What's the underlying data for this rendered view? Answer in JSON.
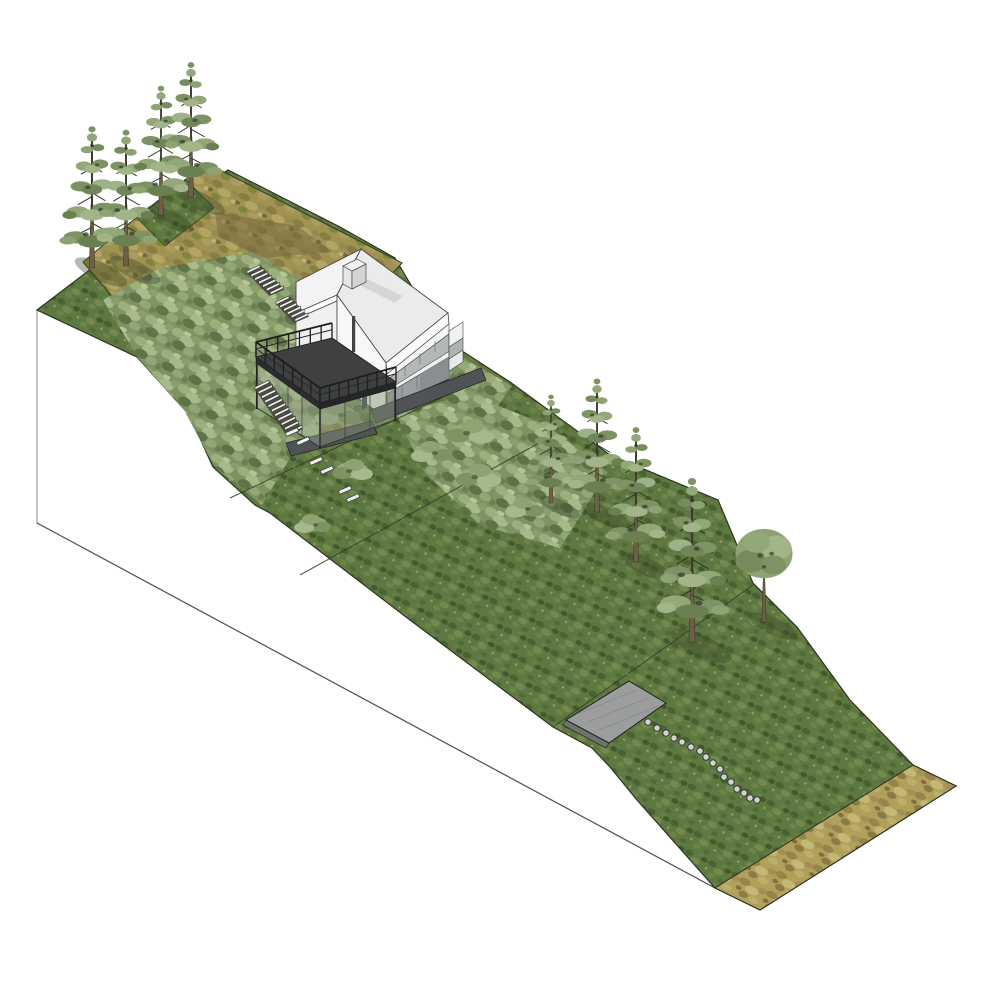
{
  "meta": {
    "title": "Hillside site axonometric rendering",
    "description": "Architectural 3D site-model rendering of a steep sloped parcel: gabled white house with timber deck, garden stairs, stepping stones, wildflower meadow terraces, a concrete pad, planting marker dots, a dry-grass strip at the toe of the slope, and conifer trees. White section-cut face on the lower left.",
    "view": "axonometric",
    "width_px": 1000,
    "height_px": 999
  },
  "palette": {
    "background": "#ffffff",
    "section_face": "#ffffff",
    "section_outline": "#8c8c8c",
    "terrain_outline": "#2d3620",
    "grass": "#5d7840",
    "grass_dark": "#49622f",
    "grass_light": "#74894d",
    "shrub": "#8aa06c",
    "meadow_tan": "#a09252",
    "dry_meadow": "#b0a05a",
    "earth_brown": "#74663f",
    "roof": "#ebebeb",
    "roof_left": "#f3f3f3",
    "wall": "#f6f6f6",
    "glazing": "#b4b8b9",
    "glazing_dark": "#898f90",
    "deck": "#3e4041",
    "path": "#4f5355",
    "pad": "#9b9e9c",
    "stair_tread": "#f0f0f0",
    "stepping_stone": "#f0f0f0",
    "marker_dot": "#d2d2d2",
    "trunk": "#6e5f48",
    "foliage": "#8ea373"
  },
  "summary": {
    "conifer_trees": 8,
    "round_trees": 1,
    "bush_clumps": 9,
    "stepping_stones": 6,
    "marker_dots": 16,
    "stair_flights": 3,
    "buildings": 1
  },
  "scene": {
    "vegetation": [
      {
        "type": "conifer",
        "x": 92,
        "y": 268,
        "s": 1.02,
        "flip": false,
        "shadow": true
      },
      {
        "type": "conifer",
        "x": 126,
        "y": 266,
        "s": 0.98,
        "flip": true,
        "shadow": true
      },
      {
        "type": "conifer",
        "x": 161,
        "y": 215,
        "s": 0.93,
        "flip": false,
        "shadow": true
      },
      {
        "type": "conifer",
        "x": 191,
        "y": 197,
        "s": 0.97,
        "flip": true,
        "shadow": true
      },
      {
        "type": "conifer",
        "x": 551,
        "y": 503,
        "s": 0.78,
        "flip": false,
        "shadow": true
      },
      {
        "type": "conifer",
        "x": 597,
        "y": 512,
        "s": 0.96,
        "flip": true,
        "shadow": true
      },
      {
        "type": "conifer",
        "x": 636,
        "y": 562,
        "s": 0.97,
        "flip": false,
        "shadow": true
      },
      {
        "type": "conifer",
        "x": 692,
        "y": 642,
        "s": 1.18,
        "flip": true,
        "shadow": true
      },
      {
        "type": "round",
        "x": 764,
        "y": 622,
        "s": 0.95,
        "flip": false,
        "shadow": true
      },
      {
        "type": "bush",
        "x": 352,
        "y": 470,
        "s": 1.0,
        "flip": false,
        "shadow": false
      },
      {
        "type": "bush",
        "x": 313,
        "y": 524,
        "s": 0.9,
        "flip": true,
        "shadow": false
      },
      {
        "type": "bush",
        "x": 478,
        "y": 476,
        "s": 1.1,
        "flip": false,
        "shadow": false
      },
      {
        "type": "bush",
        "x": 525,
        "y": 508,
        "s": 0.95,
        "flip": true,
        "shadow": false
      },
      {
        "type": "bush",
        "x": 470,
        "y": 432,
        "s": 1.15,
        "flip": false,
        "shadow": false
      },
      {
        "type": "bush",
        "x": 432,
        "y": 452,
        "s": 1.0,
        "flip": true,
        "shadow": false
      },
      {
        "type": "bush",
        "x": 300,
        "y": 426,
        "s": 1.0,
        "flip": false,
        "shadow": false
      },
      {
        "type": "bush",
        "x": 338,
        "y": 414,
        "s": 1.1,
        "flip": true,
        "shadow": false
      },
      {
        "type": "bush",
        "x": 362,
        "y": 398,
        "s": 0.9,
        "flip": false,
        "shadow": false
      }
    ],
    "marker_dots": [
      [
        648,
        722
      ],
      [
        657,
        728
      ],
      [
        666,
        733
      ],
      [
        674,
        738
      ],
      [
        682,
        742
      ],
      [
        691,
        747
      ],
      [
        700,
        751
      ],
      [
        706,
        757
      ],
      [
        713,
        763
      ],
      [
        720,
        769
      ],
      [
        724,
        777
      ],
      [
        731,
        782
      ],
      [
        737,
        789
      ],
      [
        744,
        793
      ],
      [
        750,
        798
      ],
      [
        757,
        800
      ]
    ],
    "stepping_stones": [
      [
        292,
        432
      ],
      [
        303,
        441
      ],
      [
        316,
        461
      ],
      [
        327,
        470
      ],
      [
        345,
        490
      ],
      [
        353,
        498
      ]
    ],
    "stairs": [
      {
        "x": 247,
        "y": 271,
        "n": 7,
        "sx": 3.9,
        "sy": 3.5,
        "tx": 13,
        "ty": -6.2
      },
      {
        "x": 276,
        "y": 302,
        "n": 6,
        "sx": 3.8,
        "sy": 3.4,
        "tx": 13,
        "ty": -6.2
      },
      {
        "x": 255,
        "y": 387,
        "n": 11,
        "sx": 3.3,
        "sy": 4.5,
        "tx": 14,
        "ty": -6.8
      }
    ],
    "deck_railing": {
      "height": 15,
      "edges": [
        {
          "x1": 256,
          "y1": 357,
          "x2": 332,
          "y2": 338,
          "posts": 7
        },
        {
          "x1": 256,
          "y1": 357,
          "x2": 320,
          "y2": 403,
          "posts": 7
        },
        {
          "x1": 320,
          "y1": 403,
          "x2": 396,
          "y2": 382,
          "posts": 8
        }
      ]
    }
  }
}
